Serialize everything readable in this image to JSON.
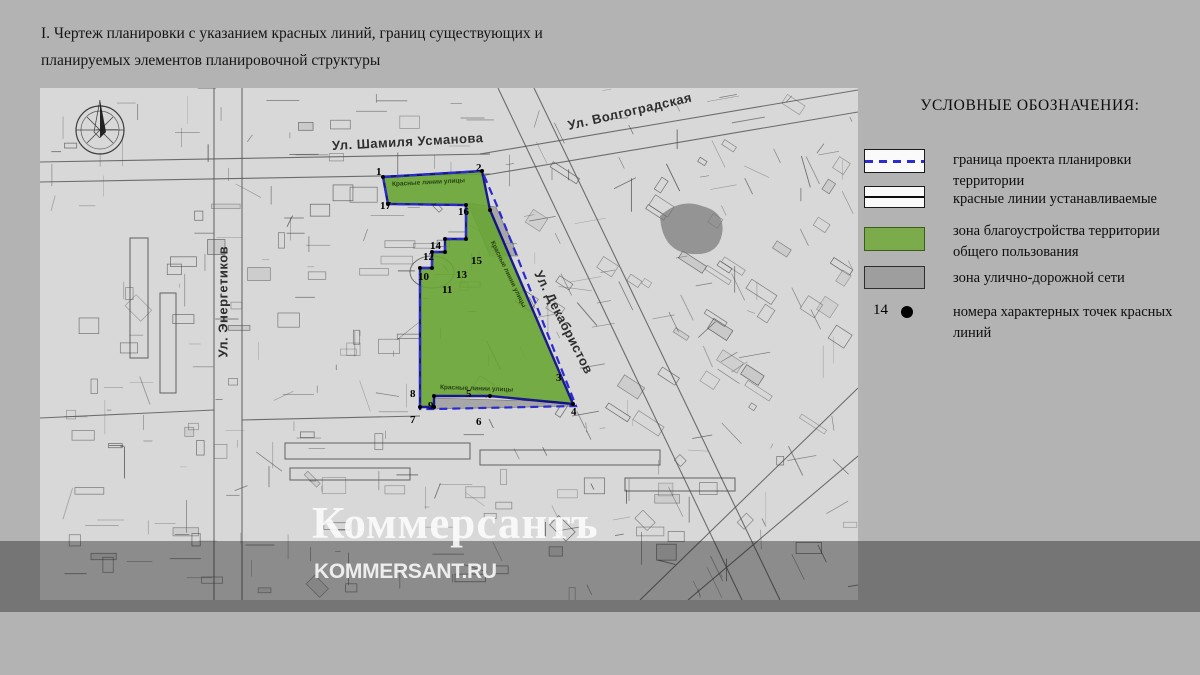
{
  "title": {
    "line1": "I. Чертеж планировки с указанием красных линий,  границ существующих и",
    "line2": "планируемых элементов планировочной структуры"
  },
  "legend": {
    "title": "УСЛОВНЫЕ ОБОЗНАЧЕНИЯ:",
    "items": [
      {
        "key": "project-boundary",
        "label": "граница проекта планировки территории"
      },
      {
        "key": "red-lines",
        "label": "красные линии устанавливаемые"
      },
      {
        "key": "landscaping-zone",
        "label": "зона  благоустройства территории общего пользования"
      },
      {
        "key": "street-network-zone",
        "label": "зона улично-дорожной сети"
      },
      {
        "key": "point-numbers",
        "number": "14",
        "label": "номера характерных точек красных линий"
      }
    ]
  },
  "map": {
    "streets": [
      {
        "name": "Ул. Шамиля Усманова",
        "x": 292,
        "y": 50,
        "rotate": -3
      },
      {
        "name": "Ул. Волгоградская",
        "x": 528,
        "y": 30,
        "rotate": -13
      },
      {
        "name": "Ул. Декабристов",
        "x": 498,
        "y": 176,
        "rotate": 63
      },
      {
        "name": "Ул. Энергетиков",
        "x": 183,
        "y": 262,
        "rotate": -90
      }
    ],
    "edge_labels": [
      {
        "text": "Красные линии улицы",
        "x": 352,
        "y": 93,
        "rotate": -3
      },
      {
        "text": "Красные линии улицы",
        "x": 452,
        "y": 150,
        "rotate": 64
      },
      {
        "text": "Красные линии улицы",
        "x": 400,
        "y": 296,
        "rotate": 2
      }
    ],
    "points": [
      {
        "n": "1",
        "x": 336,
        "y": 78
      },
      {
        "n": "2",
        "x": 436,
        "y": 74
      },
      {
        "n": "3",
        "x": 516,
        "y": 284
      },
      {
        "n": "4",
        "x": 531,
        "y": 318
      },
      {
        "n": "5",
        "x": 426,
        "y": 300
      },
      {
        "n": "6",
        "x": 436,
        "y": 328
      },
      {
        "n": "7",
        "x": 370,
        "y": 326
      },
      {
        "n": "8",
        "x": 370,
        "y": 300
      },
      {
        "n": "9",
        "x": 388,
        "y": 312
      },
      {
        "n": "10",
        "x": 378,
        "y": 183
      },
      {
        "n": "11",
        "x": 402,
        "y": 196
      },
      {
        "n": "12",
        "x": 383,
        "y": 163
      },
      {
        "n": "13",
        "x": 416,
        "y": 181
      },
      {
        "n": "14",
        "x": 390,
        "y": 152
      },
      {
        "n": "15",
        "x": 431,
        "y": 167
      },
      {
        "n": "16",
        "x": 418,
        "y": 118
      },
      {
        "n": "17",
        "x": 340,
        "y": 112
      }
    ],
    "zone_polygon": "343,89 442,83 450,122 533,316 450,308 394,308 394,319 380,319 380,180 392,180 392,164 405,164 405,151 426,151 426,117 348,116",
    "boundary_polygon": "343,89 442,83 458,120 536,318 394,321 380,321 380,180 392,180 392,164 405,164 405,151 426,151 426,117 348,116",
    "gray_zones": [
      "428,115 456,119 478,168 450,168",
      "394,310 526,314 533,318 394,321"
    ],
    "colors": {
      "zone_green": "#68a531",
      "boundary_blue": "#2b2bd0",
      "red_line": "#000080",
      "legend_green": "#7cab4b",
      "legend_gray": "#9e9e9e"
    }
  },
  "watermark": {
    "logo": "Коммерсантъ",
    "site": "KOMMERSANT.RU"
  }
}
